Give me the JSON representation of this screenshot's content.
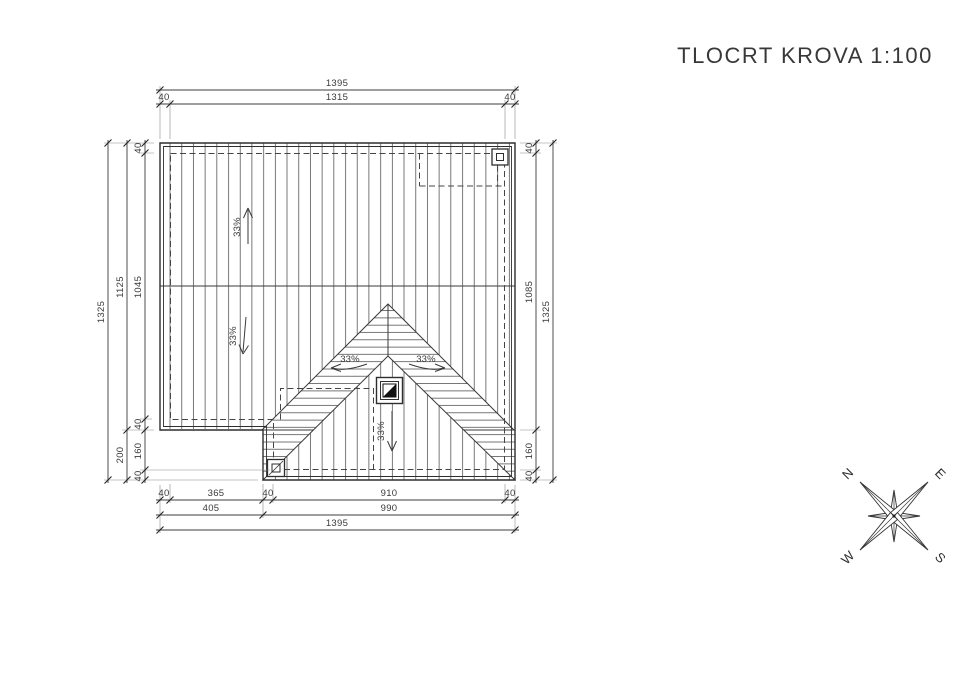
{
  "title": "TLOCRT KROVA 1:100",
  "slopes": {
    "north": "33%",
    "south": "33%",
    "west": "33%",
    "east": "33%",
    "center": "33%"
  },
  "dims": {
    "top_total": "1395",
    "top_inner": "1315",
    "top_eave_left": "40",
    "top_eave_right": "40",
    "left_total": "1325",
    "left_main": "1125",
    "left_extension": "200",
    "left_eave_top": "40",
    "left_inner": "1045",
    "left_eave_mid": "40",
    "left_inner_ext": "160",
    "left_eave_bottom": "40",
    "right_eave_top": "40",
    "right_inner": "1085",
    "right_inner_ext": "160",
    "right_eave_bottom": "40",
    "right_total": "1325",
    "bottom_eave_left": "40",
    "bottom_left": "365",
    "bottom_eave_mid": "40",
    "bottom_right": "910",
    "bottom_eave_right": "40",
    "bottom_left_total": "405",
    "bottom_right_total": "990",
    "bottom_total": "1395"
  },
  "compass": {
    "north": "N",
    "east": "E",
    "south": "S",
    "west": "W"
  }
}
